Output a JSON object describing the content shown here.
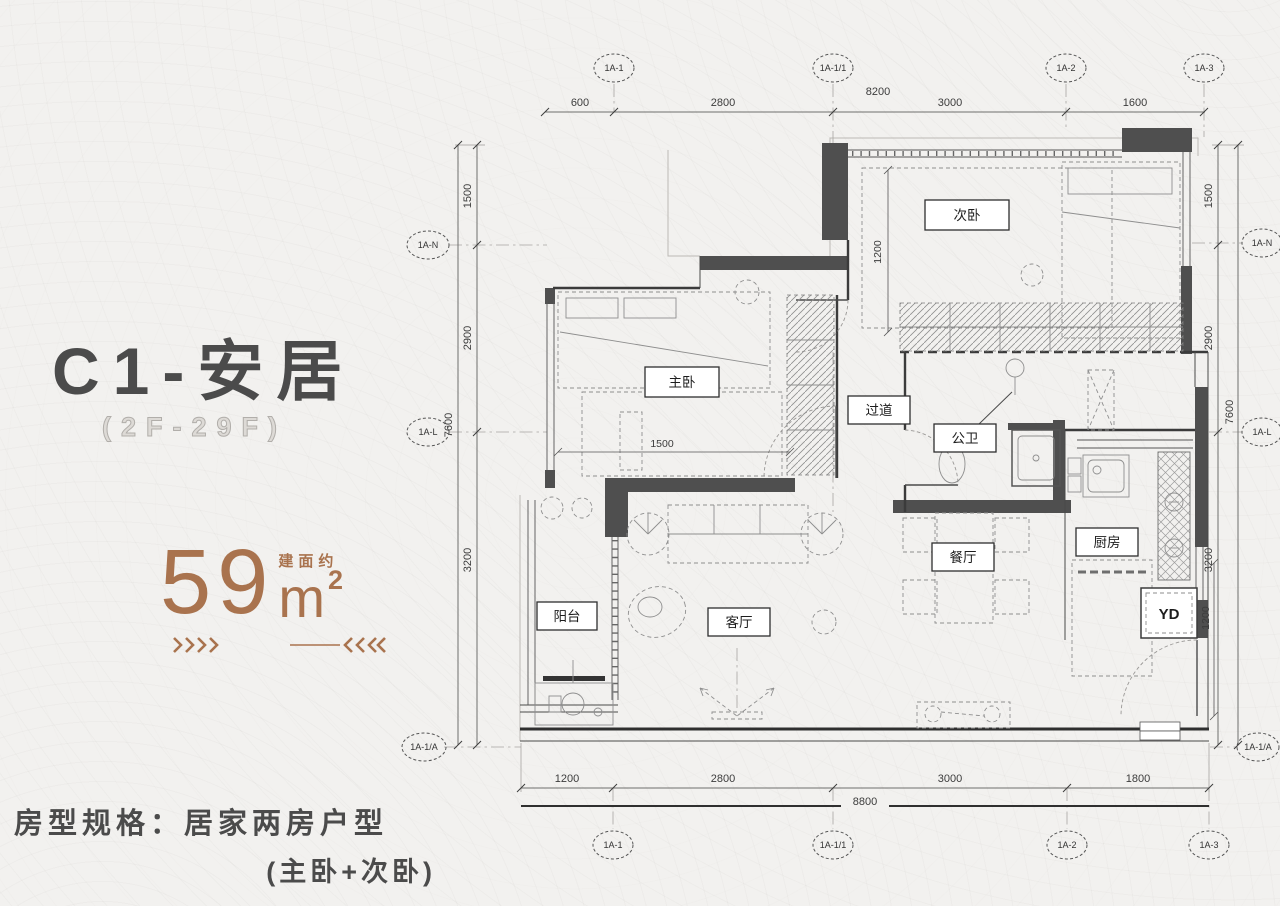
{
  "page": {
    "background": "#f2f1ef"
  },
  "info_panel": {
    "title": "C1-安居",
    "floor_range": "(2F-29F)",
    "area": {
      "prefix": "建面约",
      "value": "59",
      "unit": "m",
      "sup": "2"
    },
    "spec_line1": "房型规格：居家两房户型",
    "spec_line2": "(主卧+次卧)",
    "accent_color": "#a9734e",
    "title_color": "#4b4b4b"
  },
  "floorplan": {
    "rooms": [
      {
        "label": "次卧"
      },
      {
        "label": "主卧"
      },
      {
        "label": "过道"
      },
      {
        "label": "公卫"
      },
      {
        "label": "厨房"
      },
      {
        "label": "餐厅"
      },
      {
        "label": "客厅"
      },
      {
        "label": "阳台"
      },
      {
        "label": "YD"
      }
    ],
    "interior_dims": {
      "secondary_bedroom": "1200",
      "master_bedroom": "1500",
      "entry": "1200"
    },
    "axes": {
      "top": {
        "segments": [
          "600",
          "2800",
          "3000",
          "1600"
        ],
        "total": "8200",
        "bubbles": [
          "1A-1",
          "1A-1/1",
          "1A-2",
          "1A-3"
        ]
      },
      "bottom": {
        "segments": [
          "1200",
          "2800",
          "3000",
          "1800"
        ],
        "total": "8800",
        "bubbles": [
          "1A-1",
          "1A-1/1",
          "1A-2",
          "1A-3"
        ]
      },
      "left": {
        "segments": [
          "1500",
          "2900",
          "3200"
        ],
        "total": "7600",
        "bubbles": [
          "1A-N",
          "1A-L",
          "1A-1/A"
        ]
      },
      "right": {
        "segments": [
          "1500",
          "2900",
          "3200"
        ],
        "total": "7600",
        "bubbles": [
          "1A-N",
          "1A-L",
          "1A-1/A"
        ]
      }
    }
  }
}
